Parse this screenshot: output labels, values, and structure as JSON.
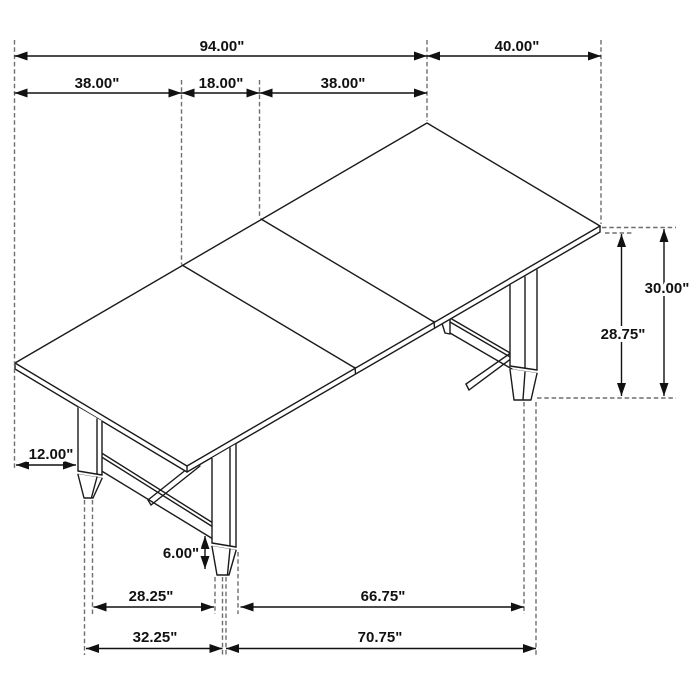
{
  "figure": {
    "subject": "Dining table — isometric line drawing with dimension annotations",
    "unit": "inches"
  },
  "dims": {
    "d94": "94.00\"",
    "d40": "40.00\"",
    "d38a": "38.00\"",
    "d18": "18.00\"",
    "d38b": "38.00\"",
    "d30": "30.00\"",
    "d2875": "28.75\"",
    "d12": "12.00\"",
    "d6": "6.00\"",
    "d2825": "28.25\"",
    "d6675": "66.75\"",
    "d3225": "32.25\"",
    "d7075": "70.75\""
  },
  "colors": {
    "line": "#1a1a1a",
    "extension_line": "#6e6e6e",
    "label": "#111111",
    "background": "#ffffff"
  }
}
